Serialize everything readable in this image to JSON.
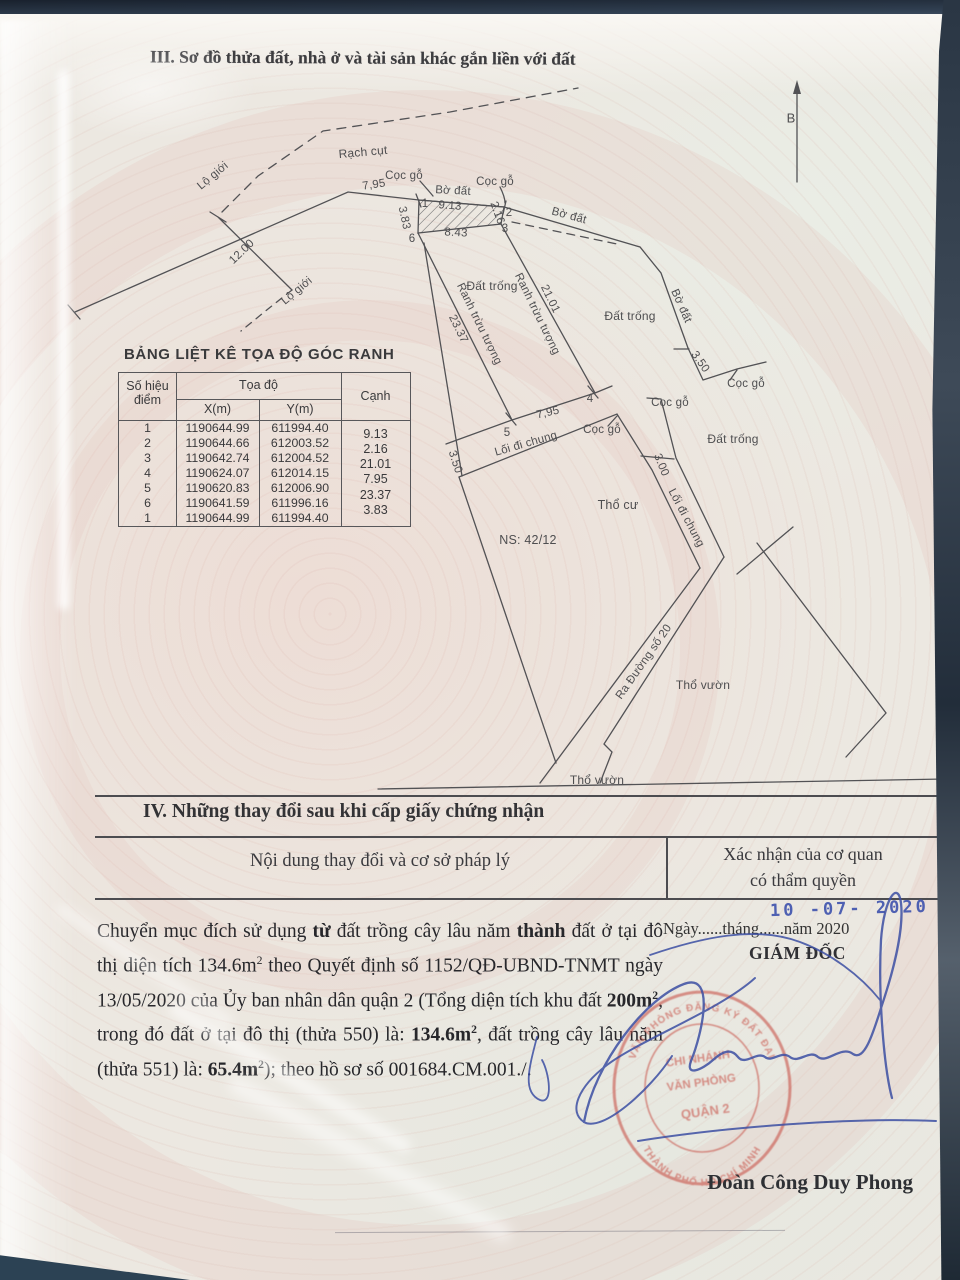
{
  "section3": {
    "title": "III. Sơ đồ thửa đất, nhà ở và tài sản khác gắn liền với đất"
  },
  "coord_table": {
    "title": "BẢNG LIỆT KÊ TỌA ĐỘ GÓC RANH",
    "col_point_1": "Số hiệu",
    "col_point_2": "điểm",
    "col_coords": "Tọa độ",
    "col_x": "X(m)",
    "col_y": "Y(m)",
    "col_edge": "Cạnh",
    "rows": [
      [
        "1",
        "1190644.99",
        "611994.40"
      ],
      [
        "2",
        "1190644.66",
        "612003.52"
      ],
      [
        "3",
        "1190642.74",
        "612004.52"
      ],
      [
        "4",
        "1190624.07",
        "612014.15"
      ],
      [
        "5",
        "1190620.83",
        "612006.90"
      ],
      [
        "6",
        "1190641.59",
        "611996.16"
      ],
      [
        "1",
        "1190644.99",
        "611994.40"
      ]
    ],
    "edges": [
      "9.13",
      "2.16",
      "21.01",
      "7.95",
      "23.37",
      "3.83"
    ]
  },
  "diagram": {
    "labels": [
      {
        "t": "B",
        "x": 791,
        "y": 118,
        "r": 0,
        "fs": 13
      },
      {
        "t": "Rạch cụt",
        "x": 363,
        "y": 152,
        "r": -5,
        "fs": 12
      },
      {
        "t": "Lộ giới",
        "x": 213,
        "y": 176,
        "r": -40
      },
      {
        "t": "Lộ giới",
        "x": 297,
        "y": 291,
        "r": -40
      },
      {
        "t": "12.00",
        "x": 242,
        "y": 252,
        "r": -44
      },
      {
        "t": "7,95",
        "x": 374,
        "y": 185,
        "r": -8
      },
      {
        "t": "Cọc gỗ",
        "x": 404,
        "y": 176,
        "r": 0
      },
      {
        "t": "Cọc gỗ",
        "x": 495,
        "y": 182,
        "r": 0
      },
      {
        "t": "Bờ đất",
        "x": 453,
        "y": 191,
        "r": 3
      },
      {
        "t": "Bờ đất",
        "x": 569,
        "y": 216,
        "r": 15
      },
      {
        "t": "Bờ đất",
        "x": 681,
        "y": 306,
        "r": 66
      },
      {
        "t": "9.13",
        "x": 450,
        "y": 206,
        "r": 4
      },
      {
        "t": "8.43",
        "x": 456,
        "y": 233,
        "r": 3
      },
      {
        "t": "3.83",
        "x": 404,
        "y": 218,
        "r": 78
      },
      {
        "t": "2.16",
        "x": 497,
        "y": 213,
        "r": 70
      },
      {
        "t": "1",
        "x": 425,
        "y": 204,
        "r": 0
      },
      {
        "t": "2",
        "x": 509,
        "y": 213,
        "r": 0
      },
      {
        "t": "3",
        "x": 505,
        "y": 229,
        "r": 0
      },
      {
        "t": "6",
        "x": 412,
        "y": 239,
        "r": 0
      },
      {
        "t": "4",
        "x": 590,
        "y": 399,
        "r": 0
      },
      {
        "t": "5",
        "x": 507,
        "y": 433,
        "r": 0
      },
      {
        "t": "Đất trống",
        "x": 492,
        "y": 286,
        "r": 0,
        "fs": 12
      },
      {
        "t": "Đất trống",
        "x": 630,
        "y": 316,
        "r": 0,
        "fs": 12
      },
      {
        "t": "Đất trống",
        "x": 733,
        "y": 439,
        "r": 0,
        "fs": 12
      },
      {
        "t": "Ranh trừu tượng",
        "x": 479,
        "y": 324,
        "r": 64
      },
      {
        "t": "23.37",
        "x": 458,
        "y": 329,
        "r": 64
      },
      {
        "t": "Ranh trừu tượng",
        "x": 537,
        "y": 314,
        "r": 64
      },
      {
        "t": "21.01",
        "x": 550,
        "y": 299,
        "r": 64
      },
      {
        "t": "3.50",
        "x": 455,
        "y": 462,
        "r": 72
      },
      {
        "t": "3.50",
        "x": 700,
        "y": 362,
        "r": 55
      },
      {
        "t": "3.00",
        "x": 661,
        "y": 465,
        "r": 68
      },
      {
        "t": "7,95",
        "x": 548,
        "y": 413,
        "r": -13
      },
      {
        "t": "Lối đi chung",
        "x": 526,
        "y": 444,
        "r": -16
      },
      {
        "t": "Lối đi chung",
        "x": 686,
        "y": 518,
        "r": 62
      },
      {
        "t": "Cọc gỗ",
        "x": 602,
        "y": 430,
        "r": 0
      },
      {
        "t": "Cọc gỗ",
        "x": 746,
        "y": 384,
        "r": 0
      },
      {
        "t": "Cọc gỗ",
        "x": 670,
        "y": 403,
        "r": 0
      },
      {
        "t": "Thổ cư",
        "x": 618,
        "y": 505,
        "r": 0,
        "fs": 12.5
      },
      {
        "t": "NS: 42/12",
        "x": 528,
        "y": 540,
        "r": 0,
        "fs": 12.5
      },
      {
        "t": "Thổ vườn",
        "x": 703,
        "y": 685,
        "r": 0,
        "fs": 12
      },
      {
        "t": "Thổ vườn",
        "x": 597,
        "y": 780,
        "r": 0,
        "fs": 12
      },
      {
        "t": "Ra Đường số 20",
        "x": 644,
        "y": 662,
        "r": -55
      }
    ]
  },
  "section4": {
    "title": "IV. Những thay đổi sau khi cấp giấy chứng nhận",
    "col_left": "Nội dung thay đổi và cơ sở pháp lý",
    "col_right_1": "Xác nhận của cơ quan",
    "col_right_2": "có thẩm quyền"
  },
  "amendments": {
    "body_segments": [
      {
        "t": "Chuyển mục đích sử dụng "
      },
      {
        "t": "từ",
        "b": 1
      },
      {
        "t": " đất trồng cây lâu năm "
      },
      {
        "t": "thành",
        "b": 1
      },
      {
        "t": " đất ở tại đô thị diện tích 134.6m"
      },
      {
        "t": "2",
        "sup": 1
      },
      {
        "t": " theo Quyết định số 1152/QĐ-UBND-TNMT ngày 13/05/2020 của Ủy ban nhân dân quận 2 (Tổng diện tích khu đất "
      },
      {
        "t": "200m",
        "b": 1
      },
      {
        "t": "2",
        "b": 1,
        "sup": 1
      },
      {
        "t": ", trong đó đất ở tại đô thị (thửa 550) là: "
      },
      {
        "t": "134.6m",
        "b": 1
      },
      {
        "t": "2",
        "b": 1,
        "sup": 1
      },
      {
        "t": ", đất trồng cây lâu năm (thửa 551) là: "
      },
      {
        "t": "65.4m",
        "b": 1
      },
      {
        "t": "2",
        "b": 1,
        "sup": 1
      },
      {
        "t": "); theo hồ sơ số 001684.CM.001./."
      }
    ],
    "date_stamp": "10 -07- 2020",
    "date_line": "Ngày......tháng......năm 2020",
    "director_title": "GIÁM ĐỐC",
    "signer_name": "Đoàn Công Duy Phong",
    "stamp": {
      "ring_top": "VĂN PHÒNG ĐĂNG KÝ ĐẤT ĐAI",
      "ring_bottom": "THÀNH PHỐ HỒ CHÍ MINH",
      "line1": "CHI NHÁNH",
      "line2": "VĂN PHÒNG",
      "line3": "QUẬN 2"
    }
  }
}
